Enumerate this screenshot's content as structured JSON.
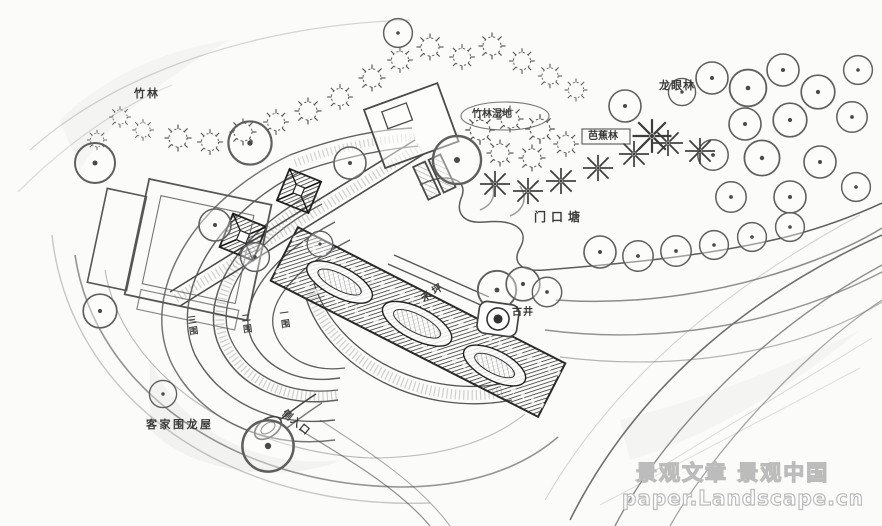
{
  "meta": {
    "title": "Hakka Weilong House landscape plan sketch",
    "background": "#fbfbf9"
  },
  "colors": {
    "pencil": "#6a6a6a",
    "pencil_dark": "#2e2e2e",
    "pencil_light": "#9a9a9a",
    "watermark_outline": "#bcbcbc"
  },
  "labels": {
    "bamboo_forest": "竹林",
    "bamboo_wetland": "竹林湿地",
    "longan_forest": "龙眼林",
    "banana_grove": "芭蕉林",
    "entrance_pond": "门口塘",
    "threshing_floor": "禾坪",
    "ancient_well": "古井",
    "ring_3": "三围",
    "ring_2": "二围",
    "ring_1": "一围",
    "hakka_house": "客家围龙屋",
    "side_entrance": "侧入口"
  },
  "watermark": {
    "line1": "景观文章  景观中国",
    "line2": "paper.Landscape.cn"
  }
}
